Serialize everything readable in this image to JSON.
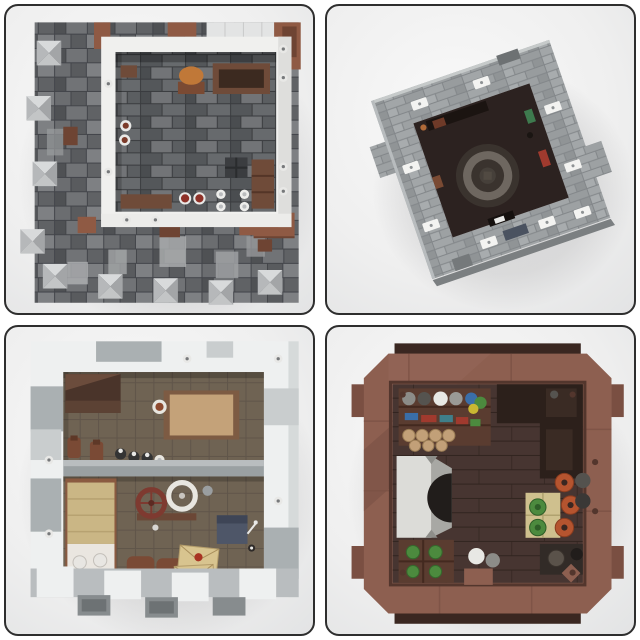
{
  "image_type": "lego-moc-product-photo-collage",
  "grid": {
    "rows": 2,
    "cols": 2
  },
  "colors": {
    "card_border": "#2e2e2e",
    "card_bg_edge": "#cbccce",
    "panel1": {
      "wall_white": "#f0f0ee",
      "roof_light": "#e3e4e4",
      "brown": "#8f5a44",
      "brown_dark": "#6e4433",
      "furniture_brown": "#6f4b39",
      "item_orange": "#c07838",
      "item_red": "#8e3128",
      "item_white": "#e9e9e7"
    },
    "panel2": {
      "interior_dark": "#2c2220",
      "disc_dark": "#3a332e",
      "ring_gray": "#6e6760",
      "accent_green": "#3e7a4e",
      "accent_red": "#a03a2e",
      "vent_slate": "#4a5260"
    },
    "panel3": {
      "wall_white": "#eef0f0",
      "wall_gray": "#aab0b2",
      "wall_gray_light": "#c9cdce",
      "divider_gray": "#9aa0a2",
      "cupboard_brown": "#4a342a",
      "table_brown": "#7d5b43",
      "table_top_tan": "#c4a279",
      "bottle_dark": "#343434",
      "bed_frame_brown": "#8a5a40",
      "bed_tan": "#cab685",
      "bed_white": "#eae6e0",
      "wheel_red": "#7e3a30",
      "wheel_white": "#e8e6e0",
      "barrel_brown": "#7a4a35",
      "envelope_tan": "#d8c48f",
      "seal_red": "#a83322",
      "desk_slate": "#4e5668",
      "plate_red": "#8e3128"
    },
    "panel4": {
      "body_brown": "#8d5f50",
      "back_plate_dark": "#3a2721",
      "rim_dark": "#53362d",
      "corner_dark": "#2c201b",
      "hearth_white": "#dcdcd8",
      "hearth_gray": "#a8a8a4",
      "hearth_dark": "#211d1b",
      "shelf_brown": "#5a3c30",
      "log_tan": "#c2a078",
      "item_white": "#e8e8e4",
      "item_blue": "#3a6ea8",
      "item_green": "#4c8a3e",
      "item_yellow": "#c9b832",
      "item_red": "#a03a2e",
      "pot_orange": "#b5542f",
      "crate_tan": "#cfc08e",
      "tab_brown": "#7a4f42"
    }
  },
  "panels": [
    {
      "position": "top-left",
      "subject": "castle-roof-battlement-level-top-view",
      "objects": [
        "dark-stone-roof-tiles",
        "pyramid-battlement-caps",
        "white-parapet-ring",
        "courtyard-floor",
        "roast-on-spit",
        "wooden-cabinet",
        "plates-of-food",
        "white-goblets",
        "wooden-benches",
        "reddish-brown-roof-patches"
      ]
    },
    {
      "position": "top-right",
      "subject": "gray-tower-top-view-rotated",
      "objects": [
        "gray-brick-wall-ring",
        "white-clip-tiles",
        "dark-interior-floor",
        "circular-ring-platform",
        "small-colored-props"
      ]
    },
    {
      "position": "bottom-left",
      "subject": "two-room-interior-floor-top-view",
      "objects": [
        "white-castle-wall-ring",
        "crenellated-bottom-wall",
        "room-divider-wall",
        "dark-cupboard",
        "wooden-table",
        "wine-bottles",
        "bed-with-tan-blanket",
        "spinning-wheel",
        "barrels",
        "sealed-envelopes",
        "writing-desk"
      ]
    },
    {
      "position": "bottom-right",
      "subject": "tavern-interior-brown-frame-top-view",
      "objects": [
        "reddish-brown-frame",
        "plank-floor",
        "shelf-with-dishes",
        "stacked-logs",
        "stone-hearth",
        "crates-of-greens",
        "clay-pots",
        "tan-crate",
        "round-tables"
      ]
    }
  ]
}
